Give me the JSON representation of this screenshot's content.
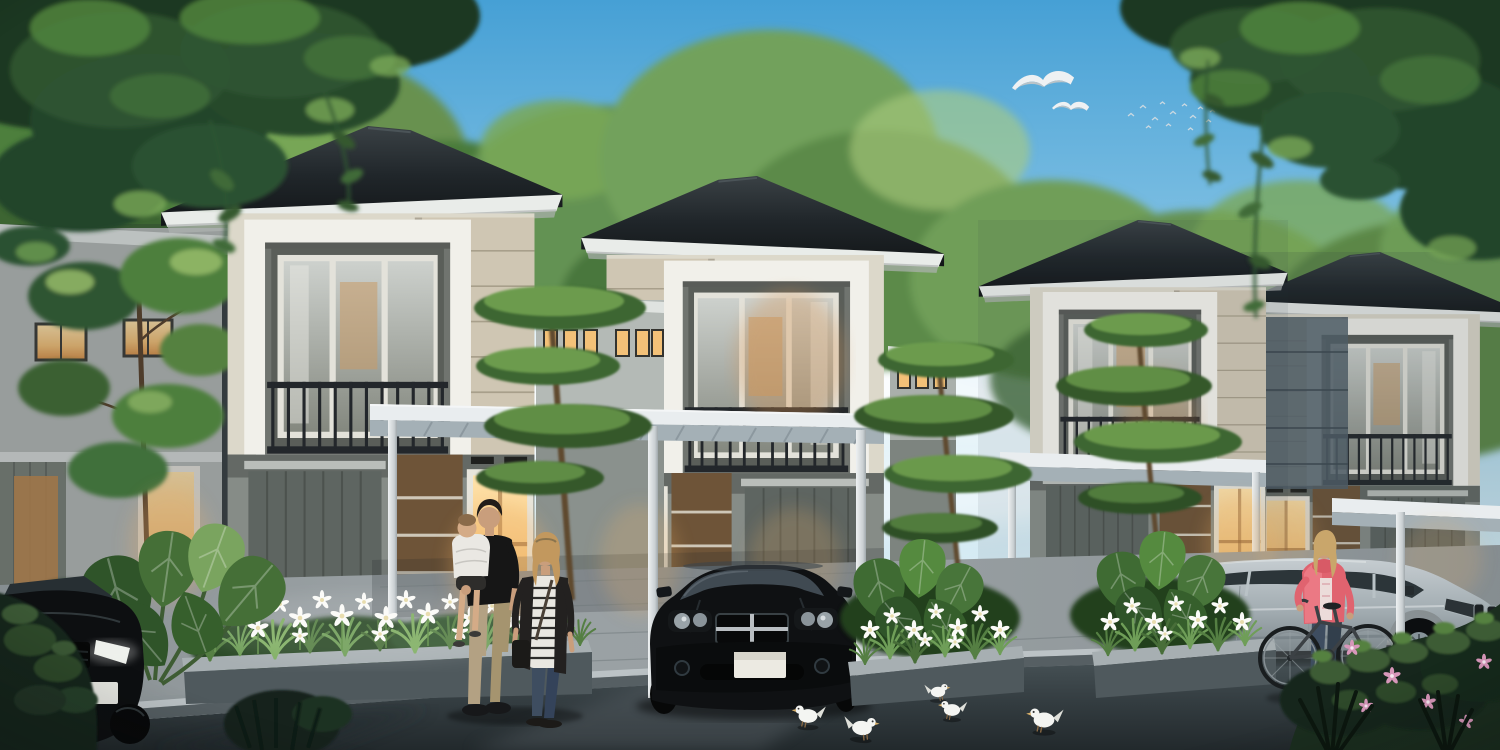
{
  "scene": {
    "title": "Modern two-storey housing row at dusk",
    "description": "Photoreal architectural rendering of a row of four identical modern minimalist two-storey houses with dark hip roofs, recessed balconies, warm glowing windows, white carport canopies, landscaped flower beds and a street in front at dusk",
    "houses": {
      "count": 4,
      "style": "modern tropical minimalist, two storeys",
      "roof": "dark charcoal hip roof with white fascia",
      "features": [
        "recessed balcony with dark metal railing",
        "beige textured stone accent panel",
        "brown accent wall with grooves",
        "white carport canopy on slim posts",
        "warm lit ground-floor door and windows",
        "low connecting walls with small lit clerestory windows"
      ]
    },
    "people": [
      {
        "id": "man-with-child",
        "description": "man in black t-shirt and khaki trousers carrying a toddler in a white top"
      },
      {
        "id": "woman-standing",
        "description": "blond woman in striped top, long dark cardigan and jeans standing beside the man"
      },
      {
        "id": "cyclist",
        "description": "blond woman in a coral pink jacket and dark jeans standing with a bicycle at the kerb"
      }
    ],
    "vehicles": [
      {
        "id": "black-sedan",
        "description": "black sedan parked facing the street under the centre carport"
      },
      {
        "id": "dark-car-left",
        "description": "dark car partially visible at the lower-left edge"
      },
      {
        "id": "silver-suv",
        "description": "silver SUV parked under the right carport facing right"
      }
    ],
    "birds": {
      "gulls_flying": 2,
      "distant_flock": 13,
      "white_doves_on_road": 5
    },
    "vegetation": [
      "overhanging leafy branches in both top corners",
      "lush background trees",
      "layered ornamental trees",
      "white iris flower beds in concrete planters",
      "large taro leaves",
      "dark foreground shrubs with pink blossoms",
      "spiky grass silhouettes"
    ]
  },
  "colors": {
    "sky_top": "#46a0d5",
    "sky_mid": "#9fd1ea",
    "sky_horizon": "#eaf4f7",
    "cloud_white": "#ffffff",
    "foliage_deep": "#1d3822",
    "foliage_dark": "#2f5430",
    "foliage_mid": "#4e7f3c",
    "foliage_light": "#79a857",
    "foliage_bright": "#aacc7d",
    "roof_dark": "#15181a",
    "roof_light": "#3a4145",
    "fascia_white": "#e9ece9",
    "wall_cream": "#dcd8ca",
    "wall_white": "#f1f0ea",
    "wall_shadow": "#8f948f",
    "stone_panel": "#cfc6b3",
    "stone_line": "#a89f8b",
    "accent_brown": "#6e5438",
    "accent_brown_lit": "#8a6a45",
    "window_warm": "#f3c178",
    "window_warm_deep": "#dd9950",
    "railing_dark": "#23272b",
    "canopy_top": "#e9edef",
    "canopy_under": "#a4b0b6",
    "post_white": "#dfe4e6",
    "drive_light": "#9aa1a4",
    "curb_light": "#bcc3c6",
    "road_dark": "#2c3437",
    "road_mid": "#4c575c",
    "planter_top": "#a7afb2",
    "planter_face": "#4f595d",
    "grass_green": "#5e8c4a",
    "flower_white": "#fbfbf8",
    "flower_pink": "#d897ba",
    "car_black": "#0f1113",
    "chrome_silver": "#b9bec2",
    "suv_silver": "#a8b1b6",
    "suv_window": "#2c3539",
    "jacket_pink": "#e0636f",
    "denim_blue": "#3e4d60",
    "khaki_tan": "#b3a183",
    "skin_tone": "#c99e7c",
    "hair_blond": "#c2985e",
    "tee_black": "#161616",
    "dove_white": "#f4f5f2"
  }
}
